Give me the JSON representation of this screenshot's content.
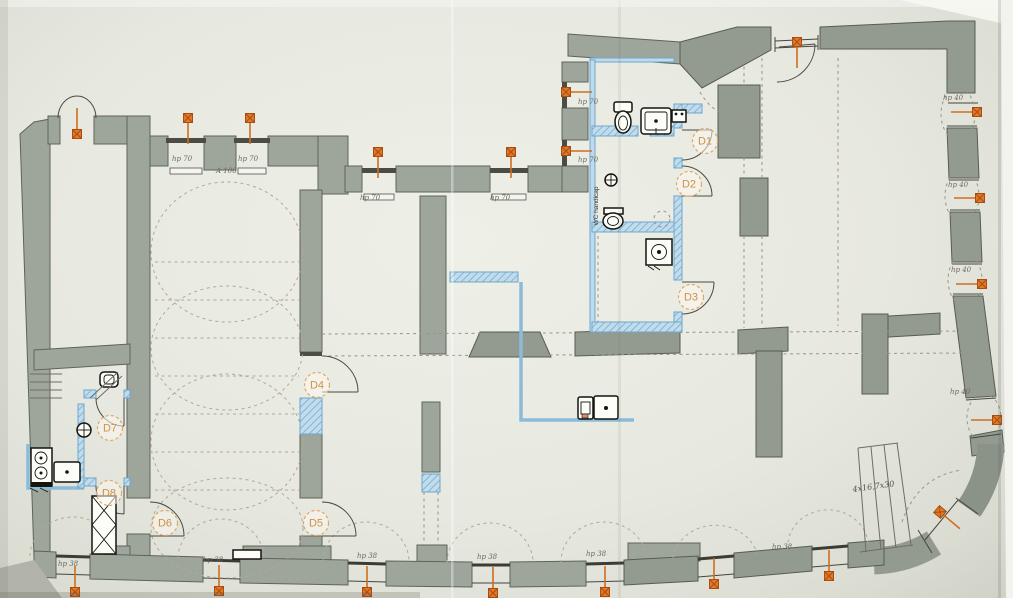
{
  "plan": {
    "doors": {
      "d1": "D1",
      "d2": "D2",
      "d3": "D3",
      "d4": "D4",
      "d5": "D5",
      "d6": "D6",
      "d7": "D7",
      "d8": "D8"
    },
    "labels": {
      "hp70": "hp 70",
      "hp40": "hp 40",
      "hp38": "hp 38",
      "stair_note": "4x16,7x30",
      "wc": "WC handicap",
      "dim1": "A 106"
    },
    "colors": {
      "paper": "#e7e8e0",
      "wall_gray": "#9ea69b",
      "wall_gray_dark": "#939b90",
      "new_wall_blue": "#6ca7cd",
      "new_wall_blue_fill": "#bfdaea",
      "marker_orange": "#cf6f1e",
      "door_label_orange": "#cf9146"
    }
  }
}
